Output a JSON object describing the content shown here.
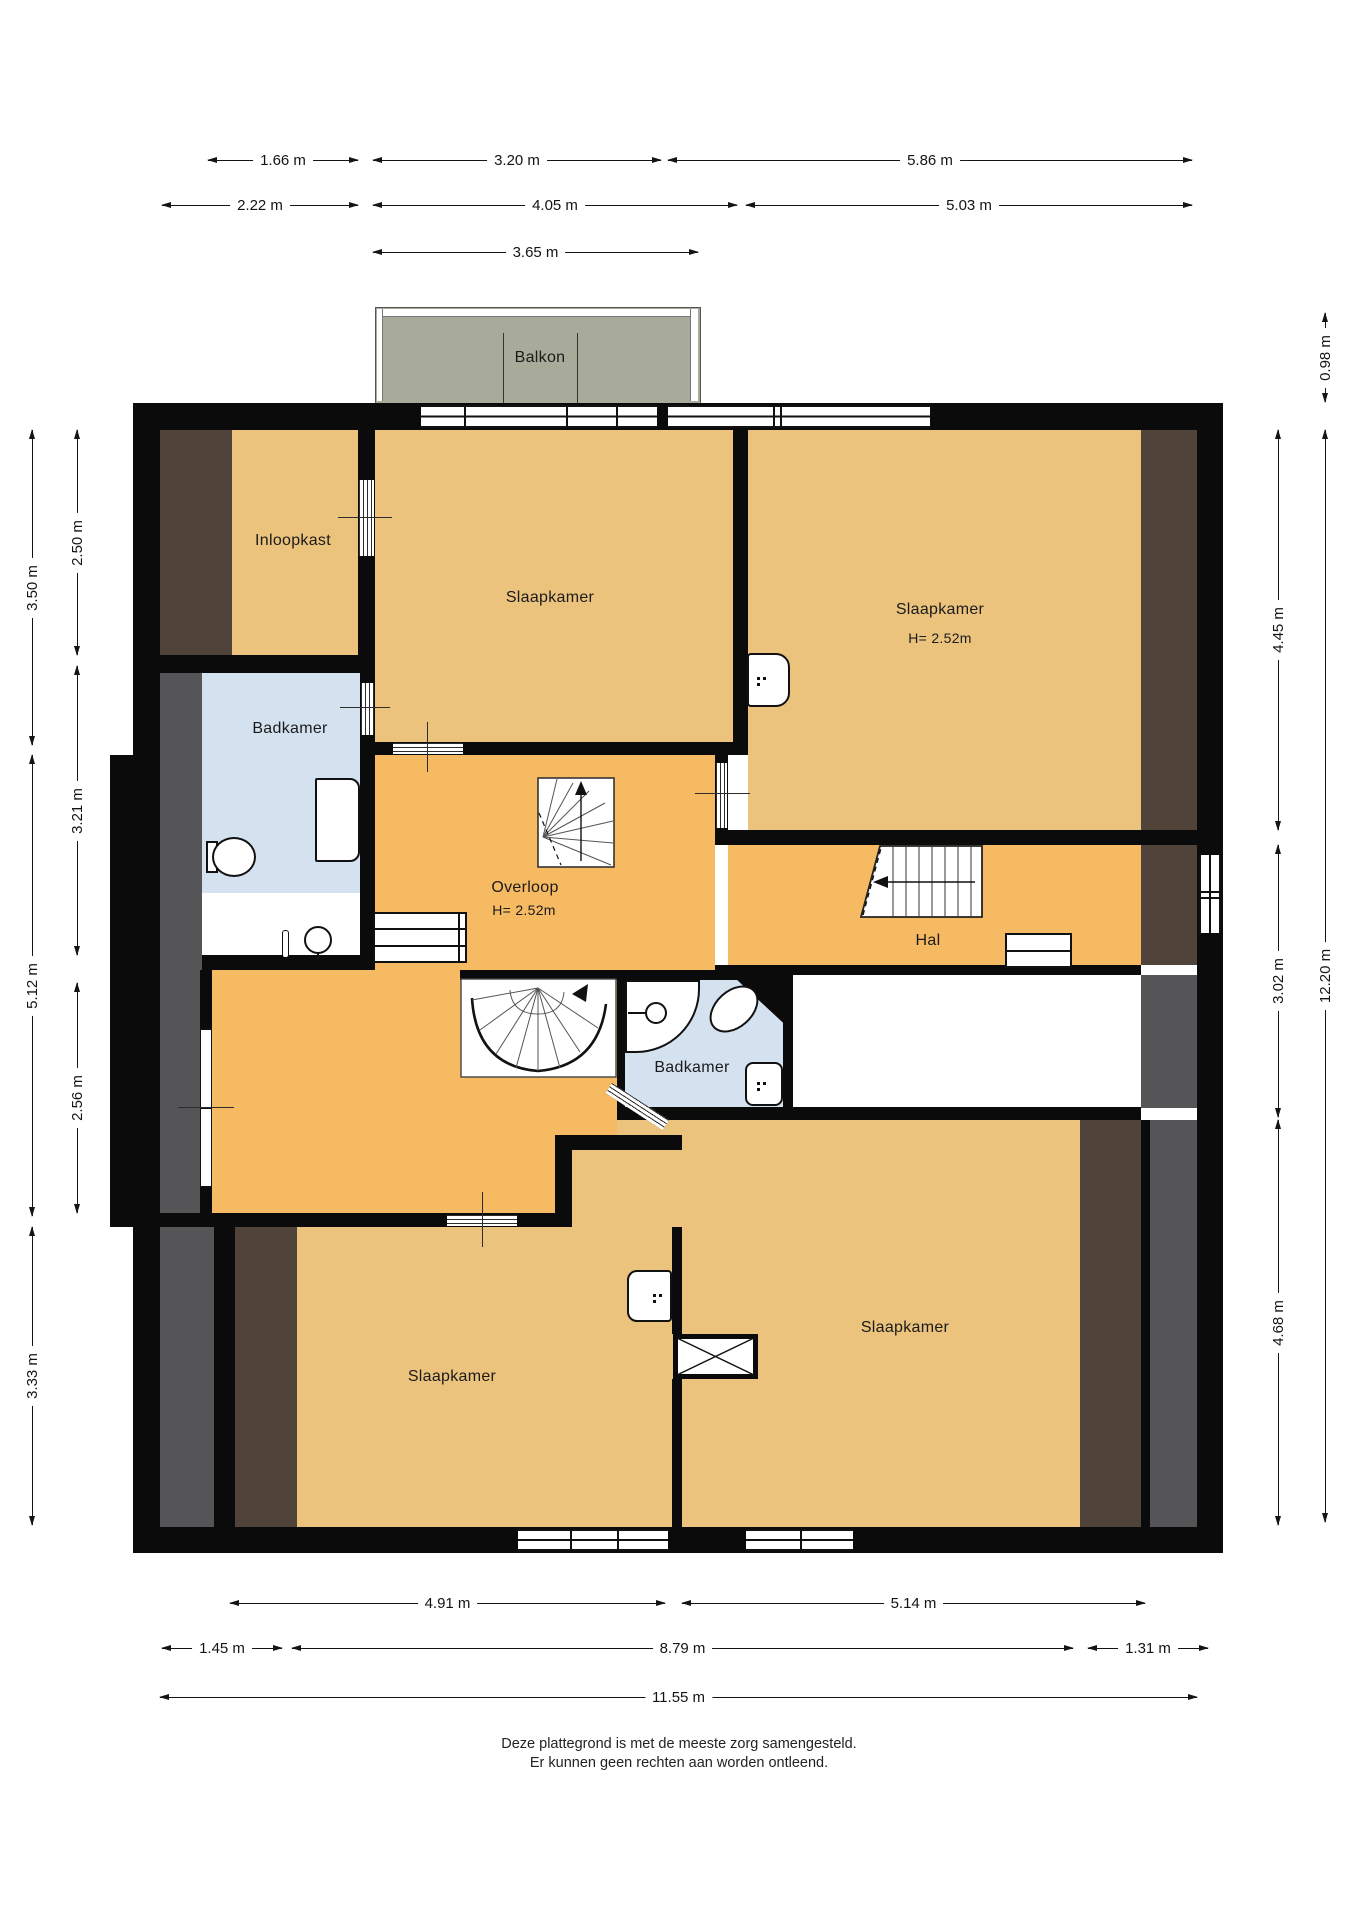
{
  "plan": {
    "type": "floorplan",
    "floor_note": "upper floor of a dwelling (Dutch labels)"
  },
  "rooms": [
    {
      "id": "balkon",
      "label": "Balkon"
    },
    {
      "id": "inloopkast",
      "label": "Inloopkast"
    },
    {
      "id": "slaapkamer-top-middle",
      "label": "Slaapkamer"
    },
    {
      "id": "slaapkamer-top-right",
      "label": "Slaapkamer",
      "height_label": "H= 2.52m"
    },
    {
      "id": "badkamer-left",
      "label": "Badkamer"
    },
    {
      "id": "overloop",
      "label": "Overloop",
      "height_label": "H= 2.52m"
    },
    {
      "id": "hal",
      "label": "Hal"
    },
    {
      "id": "badkamer-center",
      "label": "Badkamer"
    },
    {
      "id": "slaapkamer-bottom-left",
      "label": "Slaapkamer"
    },
    {
      "id": "slaapkamer-bottom-right",
      "label": "Slaapkamer"
    }
  ],
  "dimensions": {
    "top": [
      "1.66 m",
      "3.20 m",
      "5.86 m",
      "2.22 m",
      "4.05 m",
      "5.03 m",
      "3.65 m"
    ],
    "bottom": [
      "4.91 m",
      "5.14 m",
      "1.45 m",
      "8.79 m",
      "1.31 m",
      "11.55 m"
    ],
    "left": [
      "3.50 m",
      "5.12 m",
      "3.33 m",
      "2.50 m",
      "3.21 m",
      "2.56 m"
    ],
    "right": [
      "4.45 m",
      "3.02 m",
      "4.68 m",
      "0.98 m",
      "12.20 m"
    ]
  },
  "footer": {
    "line1": "Deze plattegrond is met de meeste zorg samengesteld.",
    "line2": "Er kunnen geen rechten aan worden ontleend."
  },
  "colors": {
    "wall": "#0b0b0b",
    "bedroom_fill": "#ebc37d",
    "circulation_fill": "#f6ba62",
    "bathroom_fill": "#d4e1ef",
    "balcony_fill": "#a8ab9a",
    "sloped_roof_dark_brown": "#50443a",
    "low_headroom_grey": "#555557",
    "void_fill": "#ffffff"
  }
}
